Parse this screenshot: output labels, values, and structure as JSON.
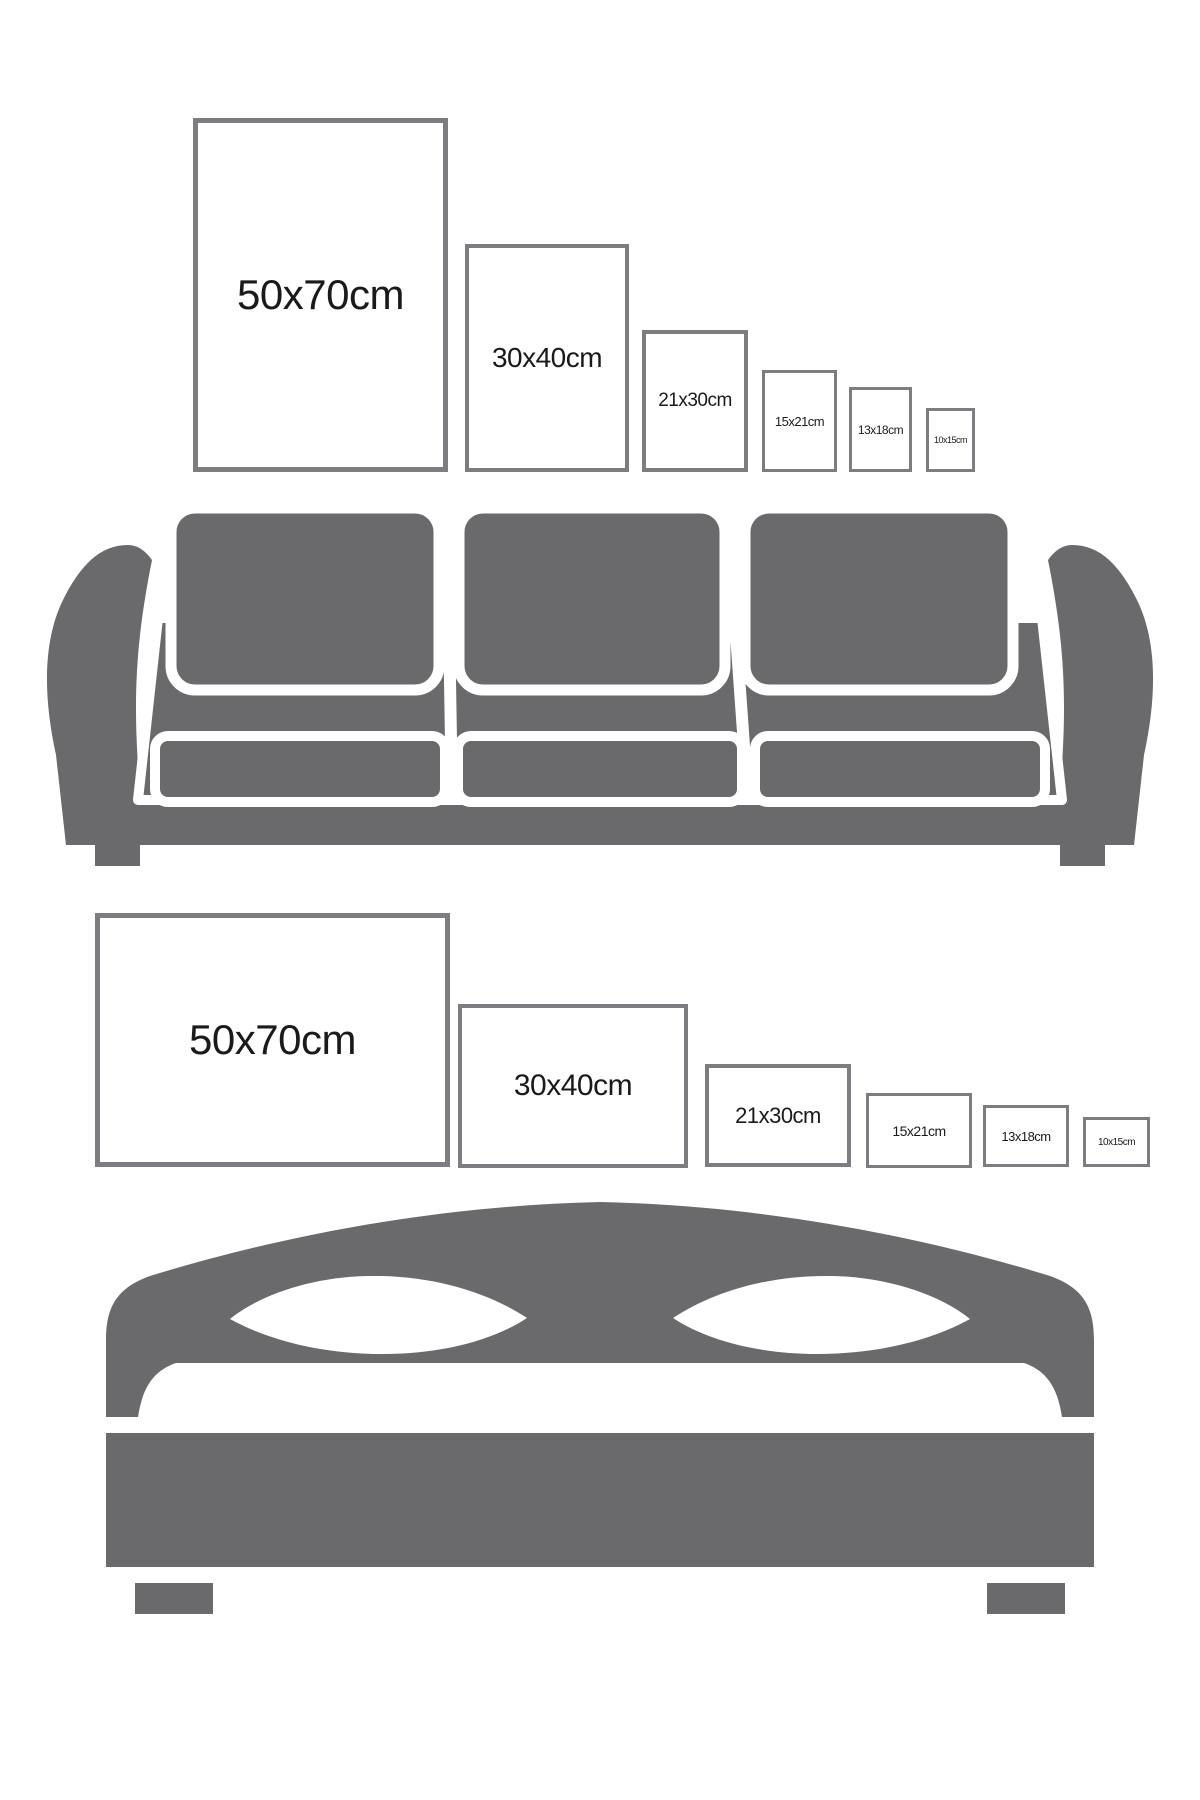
{
  "title": "Poster size guide above sofa and bed",
  "colors": {
    "background": "#ffffff",
    "furniture": "#6a6a6d",
    "frame_border": "#7b7d80",
    "text": "#1a1a1a",
    "pillow": "#ffffff",
    "outline": "#ffffff"
  },
  "sofa_section": {
    "furniture_name": "three-seat sofa",
    "frame_orientation": "portrait",
    "frames": [
      {
        "label": "50x70cm",
        "size_cm": "50x70"
      },
      {
        "label": "30x40cm",
        "size_cm": "30x40"
      },
      {
        "label": "21x30cm",
        "size_cm": "21x30"
      },
      {
        "label": "15x21cm",
        "size_cm": "15x21"
      },
      {
        "label": "13x18cm",
        "size_cm": "13x18"
      },
      {
        "label": "10x15cm",
        "size_cm": "10x15"
      }
    ]
  },
  "bed_section": {
    "furniture_name": "double bed",
    "frame_orientation": "landscape",
    "frames": [
      {
        "label": "50x70cm",
        "size_cm": "50x70"
      },
      {
        "label": "30x40cm",
        "size_cm": "30x40"
      },
      {
        "label": "21x30cm",
        "size_cm": "21x30"
      },
      {
        "label": "15x21cm",
        "size_cm": "15x21"
      },
      {
        "label": "13x18cm",
        "size_cm": "13x18"
      },
      {
        "label": "10x15cm",
        "size_cm": "10x15"
      }
    ]
  }
}
